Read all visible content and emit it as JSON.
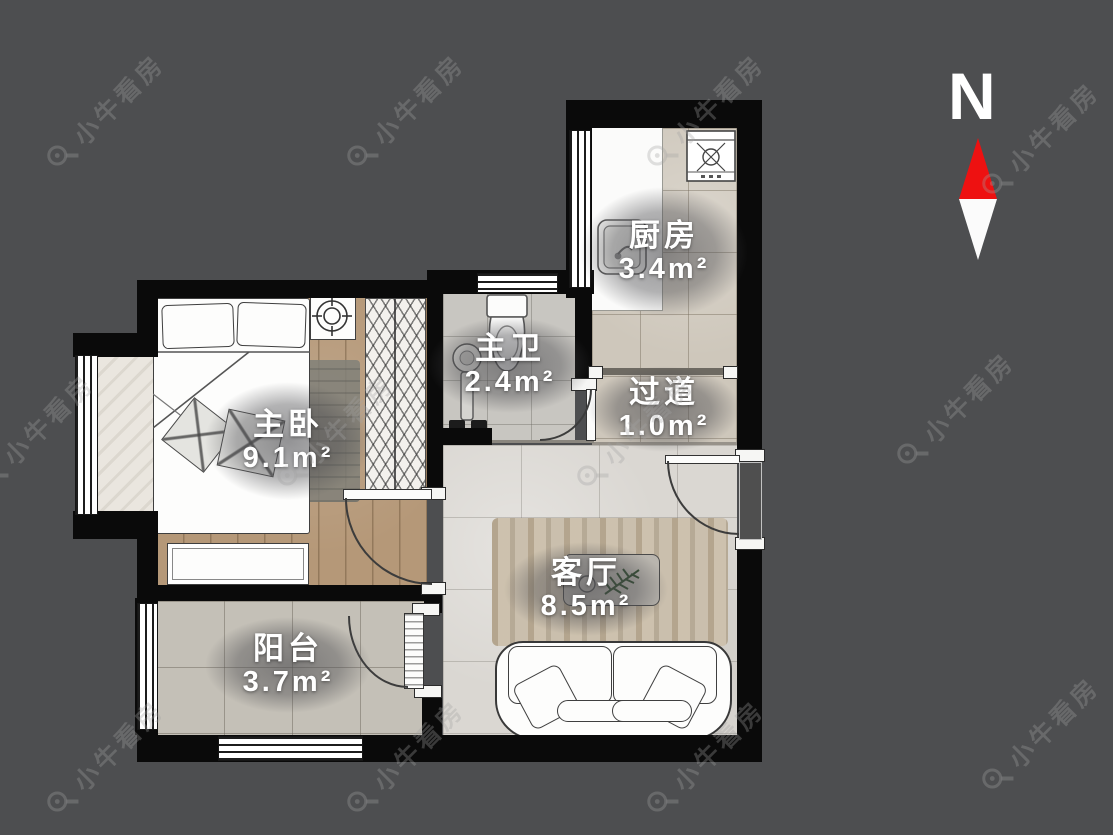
{
  "compass": {
    "north_label": "N"
  },
  "watermark": {
    "text": "小牛看房"
  },
  "rooms": {
    "kitchen": {
      "name": "厨房",
      "area": "3.4m²"
    },
    "bathroom": {
      "name": "主卫",
      "area": "2.4m²"
    },
    "hallway": {
      "name": "过道",
      "area": "1.0m²"
    },
    "bedroom": {
      "name": "主卧",
      "area": "9.1m²"
    },
    "living": {
      "name": "客厅",
      "area": "8.5m²"
    },
    "balcony": {
      "name": "阳台",
      "area": "3.7m²"
    }
  },
  "colors": {
    "background": "#4d4e50",
    "wall": "#0a0a0a",
    "compass_red": "#ee1111",
    "label_text": "#ffffff",
    "watermark_gray": "#a3a3a3"
  }
}
